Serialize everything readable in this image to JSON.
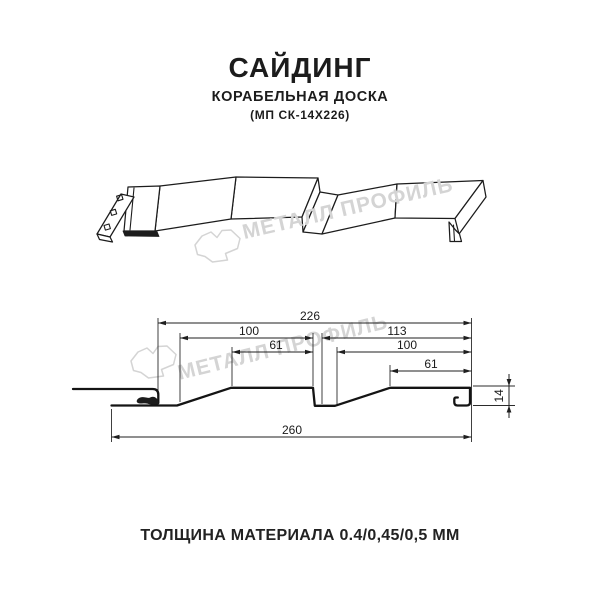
{
  "header": {
    "title": "САЙДИНГ",
    "subtitle": "КОРАБЕЛЬНАЯ ДОСКА",
    "code": "(МП СК-14Х226)"
  },
  "watermark": {
    "text": "МЕТАЛЛ ПРОФИЛЬ",
    "color": "#d4d4d4"
  },
  "dims": {
    "total_top": "226",
    "board1_width": "100",
    "board2_width": "113",
    "board1_flat": "61",
    "board2_inner": "100",
    "board2_flat": "61",
    "overall_width": "260",
    "profile_height": "14"
  },
  "footer": {
    "text": "ТОЛЩИНА МАТЕРИАЛА 0.4/0,45/0,5 ММ"
  },
  "colors": {
    "line": "#1a1a1a",
    "dim": "#1f1f1f",
    "watermark": "#d4d4d4",
    "background": "#ffffff"
  }
}
